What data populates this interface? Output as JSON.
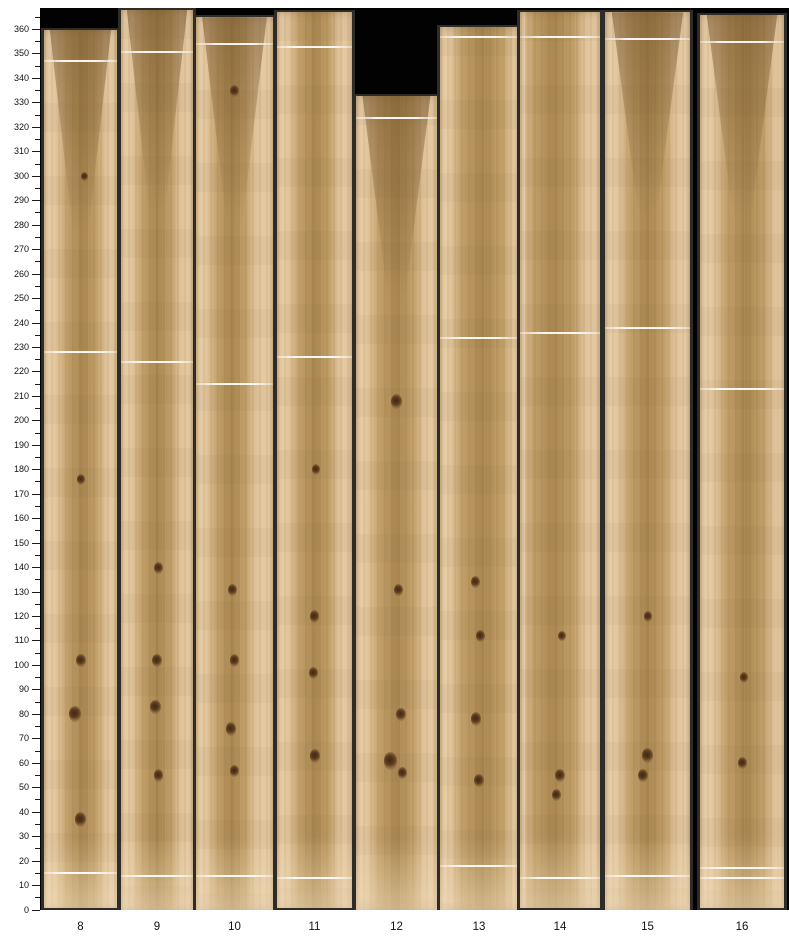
{
  "y_axis": {
    "unit_min": 0,
    "unit_max": 360,
    "major_step": 10,
    "minor_step": 5,
    "minor_tick_max": 365,
    "major_tick_labels": [
      "0",
      "10",
      "20",
      "30",
      "40",
      "50",
      "60",
      "70",
      "80",
      "90",
      "100",
      "110",
      "120",
      "130",
      "140",
      "150",
      "160",
      "170",
      "180",
      "190",
      "200",
      "210",
      "220",
      "230",
      "240",
      "250",
      "260",
      "270",
      "280",
      "290",
      "300",
      "310",
      "320",
      "330",
      "340",
      "350",
      "360"
    ]
  },
  "x_axis": {
    "labels": [
      "8",
      "9",
      "10",
      "11",
      "12",
      "13",
      "14",
      "15",
      "16"
    ]
  },
  "colors": {
    "sapwood": "#e8cda6",
    "heartwood": "#aa8750",
    "scan_margin": "#2e2c28",
    "plot_background": "#020202",
    "splice_line": "#ffffff",
    "tick": "#1a1a1a",
    "label_text": "#111111"
  },
  "boards": [
    {
      "label": "8",
      "x": 44,
      "w": 73,
      "top": 360,
      "bottom": 1,
      "heart_center": 0.52,
      "heart_width": 0.4,
      "flare": true,
      "lines": [
        347,
        228,
        15
      ],
      "knots": [
        {
          "y": 300,
          "x": 0.55,
          "s": 7
        },
        {
          "y": 176,
          "x": 0.5,
          "s": 8
        },
        {
          "y": 102,
          "x": 0.5,
          "s": 10
        },
        {
          "y": 80,
          "x": 0.42,
          "s": 12
        },
        {
          "y": 37,
          "x": 0.5,
          "s": 11
        }
      ]
    },
    {
      "label": "9",
      "x": 121,
      "w": 72,
      "top": 368,
      "bottom": 0,
      "heart_center": 0.5,
      "heart_width": 0.4,
      "flare": true,
      "lines": [
        351,
        224,
        14
      ],
      "knots": [
        {
          "y": 140,
          "x": 0.52,
          "s": 9
        },
        {
          "y": 102,
          "x": 0.5,
          "s": 10
        },
        {
          "y": 83,
          "x": 0.48,
          "s": 11
        },
        {
          "y": 55,
          "x": 0.52,
          "s": 9
        }
      ]
    },
    {
      "label": "10",
      "x": 196,
      "w": 77,
      "top": 365,
      "bottom": 0,
      "heart_center": 0.46,
      "heart_width": 0.36,
      "flare": true,
      "lines": [
        354,
        215,
        14
      ],
      "knots": [
        {
          "y": 335,
          "x": 0.5,
          "s": 9
        },
        {
          "y": 131,
          "x": 0.48,
          "s": 9
        },
        {
          "y": 102,
          "x": 0.5,
          "s": 9
        },
        {
          "y": 74,
          "x": 0.46,
          "s": 10
        },
        {
          "y": 57,
          "x": 0.5,
          "s": 9
        }
      ]
    },
    {
      "label": "11",
      "x": 277,
      "w": 75,
      "top": 367,
      "bottom": 1,
      "heart_center": 0.5,
      "heart_width": 0.4,
      "flare": false,
      "lines": [
        353,
        226,
        13
      ],
      "knots": [
        {
          "y": 180,
          "x": 0.52,
          "s": 8
        },
        {
          "y": 120,
          "x": 0.5,
          "s": 9
        },
        {
          "y": 97,
          "x": 0.48,
          "s": 9
        },
        {
          "y": 63,
          "x": 0.5,
          "s": 10
        }
      ]
    },
    {
      "label": "12",
      "x": 356,
      "w": 81,
      "top": 333,
      "bottom": 0,
      "heart_center": 0.5,
      "heart_width": 0.42,
      "flare": true,
      "lines": [
        324
      ],
      "knots": [
        {
          "y": 208,
          "x": 0.5,
          "s": 11
        },
        {
          "y": 131,
          "x": 0.52,
          "s": 9
        },
        {
          "y": 80,
          "x": 0.55,
          "s": 10
        },
        {
          "y": 61,
          "x": 0.42,
          "s": 13
        },
        {
          "y": 56,
          "x": 0.58,
          "s": 9
        }
      ]
    },
    {
      "label": "13",
      "x": 440,
      "w": 78,
      "top": 361,
      "bottom": 0,
      "heart_center": 0.54,
      "heart_width": 0.52,
      "flare": false,
      "lines": [
        357,
        234,
        18
      ],
      "knots": [
        {
          "y": 134,
          "x": 0.45,
          "s": 9
        },
        {
          "y": 112,
          "x": 0.52,
          "s": 9
        },
        {
          "y": 78,
          "x": 0.46,
          "s": 10
        },
        {
          "y": 53,
          "x": 0.5,
          "s": 10
        }
      ]
    },
    {
      "label": "14",
      "x": 520,
      "w": 80,
      "top": 367,
      "bottom": 1,
      "heart_center": 0.42,
      "heart_width": 0.52,
      "flare": false,
      "lines": [
        357,
        236,
        13
      ],
      "knots": [
        {
          "y": 112,
          "x": 0.52,
          "s": 8
        },
        {
          "y": 55,
          "x": 0.5,
          "s": 10
        },
        {
          "y": 47,
          "x": 0.46,
          "s": 9
        }
      ]
    },
    {
      "label": "15",
      "x": 605,
      "w": 85,
      "top": 367,
      "bottom": 0,
      "heart_center": 0.5,
      "heart_width": 0.4,
      "flare": true,
      "lines": [
        356,
        238,
        14
      ],
      "knots": [
        {
          "y": 120,
          "x": 0.5,
          "s": 8
        },
        {
          "y": 63,
          "x": 0.5,
          "s": 11
        },
        {
          "y": 55,
          "x": 0.45,
          "s": 10
        }
      ]
    },
    {
      "label": "16",
      "x": 700,
      "w": 84,
      "top": 366,
      "bottom": 1,
      "heart_center": 0.54,
      "heart_width": 0.44,
      "flare": true,
      "lines": [
        355,
        213,
        17,
        13
      ],
      "knots": [
        {
          "y": 95,
          "x": 0.52,
          "s": 8
        },
        {
          "y": 60,
          "x": 0.5,
          "s": 9
        }
      ]
    }
  ],
  "chart_data": {
    "type": "bar",
    "title": "",
    "xlabel": "",
    "ylabel": "",
    "categories": [
      "8",
      "9",
      "10",
      "11",
      "12",
      "13",
      "14",
      "15",
      "16"
    ],
    "series": [
      {
        "name": "board lower end",
        "values": [
          1,
          0,
          0,
          1,
          0,
          0,
          1,
          0,
          1
        ]
      },
      {
        "name": "board upper end",
        "values": [
          360,
          368,
          365,
          367,
          333,
          361,
          367,
          367,
          366
        ]
      }
    ],
    "ylim": [
      0,
      360
    ],
    "y_major_tick_step": 10,
    "y_minor_tick_step": 5,
    "grid": false,
    "legend": "none",
    "notes_visible_features": {
      "splice_lines_by_board": {
        "8": [
          347,
          228,
          15
        ],
        "9": [
          351,
          224,
          14
        ],
        "10": [
          354,
          215,
          14
        ],
        "11": [
          353,
          226,
          13
        ],
        "12": [
          324
        ],
        "13": [
          357,
          234,
          18
        ],
        "14": [
          357,
          236,
          13
        ],
        "15": [
          356,
          238,
          14
        ],
        "16": [
          355,
          213,
          17,
          13
        ]
      }
    }
  }
}
